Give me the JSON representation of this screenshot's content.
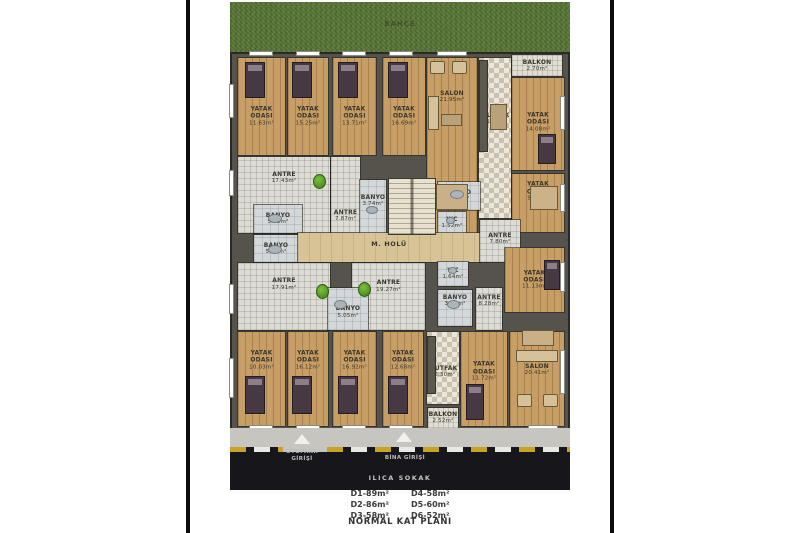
{
  "title": "NORMAL KAT PLANI",
  "street_label": "ILICA SOKAK",
  "garden_label": "BAHÇE",
  "entrances": {
    "otopark_line1": "OTOPARK",
    "otopark_line2": "GİRİŞİ",
    "bina": "BİNA GİRİŞİ"
  },
  "legend": {
    "left": [
      "D1-89m²",
      "D2-86m²",
      "D3-58m²"
    ],
    "right": [
      "D4-58m²",
      "D5-60m²",
      "D6-52m²"
    ]
  },
  "colors": {
    "grass": "#5d7a3a",
    "road": "#17171b",
    "wood_floor": "#c79e66",
    "wall": "#55534c",
    "plant_green": "#4e9b1e",
    "curb_yellow": "#c9a227"
  },
  "rooms": [
    {
      "name": "YATAK ODASI",
      "size": "11.63m²",
      "x": 238,
      "y": 58,
      "w": 47,
      "h": 97,
      "floor": "wood",
      "lt": 0.6
    },
    {
      "name": "YATAK ODASI",
      "size": "15.25m²",
      "x": 288,
      "y": 58,
      "w": 40,
      "h": 97,
      "floor": "wood",
      "lt": 0.6
    },
    {
      "name": "YATAK ODASI",
      "size": "13.71m²",
      "x": 333,
      "y": 58,
      "w": 43,
      "h": 97,
      "floor": "wood",
      "lt": 0.6
    },
    {
      "name": "YATAK ODASI",
      "size": "16.69m²",
      "x": 383,
      "y": 58,
      "w": 42,
      "h": 97,
      "floor": "wood",
      "lt": 0.6
    },
    {
      "name": "SALON",
      "size": "21.95m²",
      "x": 427,
      "y": 58,
      "w": 50,
      "h": 175,
      "floor": "wood",
      "lt": 0.22
    },
    {
      "name": "MUTFAK",
      "size": "11.62m²",
      "x": 479,
      "y": 58,
      "w": 32,
      "h": 160,
      "floor": "check",
      "lt": 0.38
    },
    {
      "name": "BALKON",
      "size": "2.70m²",
      "x": 512,
      "y": 55,
      "w": 50,
      "h": 21,
      "floor": "balk"
    },
    {
      "name": "YATAK ODASI",
      "size": "14.08m²",
      "x": 512,
      "y": 78,
      "w": 52,
      "h": 92,
      "floor": "wood",
      "lt": 0.48
    },
    {
      "name": "YATAK ODASI",
      "size": "9.27m²",
      "x": 512,
      "y": 174,
      "w": 52,
      "h": 58,
      "floor": "wood",
      "lt": 0.3
    },
    {
      "name": "ANTRE",
      "size": "17.43m²",
      "x": 238,
      "y": 157,
      "w": 92,
      "h": 76,
      "floor": "grid",
      "lt": 0.28
    },
    {
      "name": "BANYO",
      "size": "5.35m²",
      "x": 254,
      "y": 205,
      "w": 48,
      "h": 28,
      "floor": "tile"
    },
    {
      "name": "BANYO",
      "size": "5.73m²",
      "x": 254,
      "y": 235,
      "w": 44,
      "h": 27,
      "floor": "tile"
    },
    {
      "name": "ANTRE",
      "size": "7.87m²",
      "x": 331,
      "y": 157,
      "w": 29,
      "h": 76,
      "floor": "grid",
      "lt": 0.78
    },
    {
      "name": "BANYO",
      "size": "3.74m²",
      "x": 360,
      "y": 180,
      "w": 26,
      "h": 55,
      "floor": "tile",
      "lt": 0.38
    },
    {
      "name": "BANYO",
      "size": "4.53m²",
      "x": 438,
      "y": 182,
      "w": 42,
      "h": 28,
      "floor": "tile"
    },
    {
      "name": "WC",
      "size": "1.52m²",
      "x": 438,
      "y": 212,
      "w": 28,
      "h": 22,
      "floor": "tile"
    },
    {
      "name": "M. HOLÜ",
      "size": "",
      "x": 298,
      "y": 233,
      "w": 182,
      "h": 29,
      "floor": "stone",
      "lt": 0.42
    },
    {
      "name": "ANTRE",
      "size": "7.80m²",
      "x": 480,
      "y": 220,
      "w": 40,
      "h": 42,
      "floor": "grid",
      "lt": 0.45
    },
    {
      "name": "ANTRE",
      "size": "17.91m²",
      "x": 238,
      "y": 263,
      "w": 92,
      "h": 67,
      "floor": "grid",
      "lt": 0.32
    },
    {
      "name": "ANTRE",
      "size": "19.27m²",
      "x": 352,
      "y": 263,
      "w": 73,
      "h": 67,
      "floor": "grid",
      "lt": 0.35
    },
    {
      "name": "BANYO",
      "size": "5.05m²",
      "x": 328,
      "y": 288,
      "w": 40,
      "h": 42,
      "floor": "tile",
      "lt": 0.58
    },
    {
      "name": "WC",
      "size": "1.64m²",
      "x": 438,
      "y": 262,
      "w": 30,
      "h": 24,
      "floor": "tile"
    },
    {
      "name": "BANYO",
      "size": "3.83m²",
      "x": 438,
      "y": 290,
      "w": 34,
      "h": 36,
      "floor": "tile",
      "lt": 0.3
    },
    {
      "name": "ANTRE",
      "size": "8.28m²",
      "x": 476,
      "y": 288,
      "w": 26,
      "h": 42,
      "floor": "grid",
      "lt": 0.3
    },
    {
      "name": "YATAK ODASI",
      "size": "11.13m²",
      "x": 505,
      "y": 248,
      "w": 59,
      "h": 64,
      "floor": "wood"
    },
    {
      "name": "YATAK ODASI",
      "size": "10.03m²",
      "x": 238,
      "y": 332,
      "w": 47,
      "h": 94,
      "floor": "wood",
      "lt": 0.3
    },
    {
      "name": "YATAK ODASI",
      "size": "16.12m²",
      "x": 288,
      "y": 332,
      "w": 40,
      "h": 94,
      "floor": "wood",
      "lt": 0.3
    },
    {
      "name": "YATAK ODASI",
      "size": "16.92m²",
      "x": 333,
      "y": 332,
      "w": 43,
      "h": 94,
      "floor": "wood",
      "lt": 0.3
    },
    {
      "name": "YATAK ODASI",
      "size": "12.68m²",
      "x": 383,
      "y": 332,
      "w": 40,
      "h": 94,
      "floor": "wood",
      "lt": 0.3
    },
    {
      "name": "MUTFAK",
      "size": "12.30m²",
      "x": 427,
      "y": 332,
      "w": 32,
      "h": 72,
      "floor": "check",
      "lt": 0.55
    },
    {
      "name": "BALKON",
      "size": "2.52m²",
      "x": 428,
      "y": 408,
      "w": 30,
      "h": 20,
      "floor": "balk"
    },
    {
      "name": "YATAK ODASI",
      "size": "11.72m²",
      "x": 461,
      "y": 332,
      "w": 46,
      "h": 94,
      "floor": "wood",
      "lt": 0.42
    },
    {
      "name": "SALON",
      "size": "20.41m²",
      "x": 510,
      "y": 332,
      "w": 54,
      "h": 94,
      "floor": "wood",
      "lt": 0.4
    }
  ],
  "furniture": [
    {
      "type": "stairs",
      "x": 388,
      "y": 178,
      "w": 48,
      "h": 57
    },
    {
      "type": "counter",
      "x": 479,
      "y": 60,
      "w": 9,
      "h": 92
    },
    {
      "type": "counter",
      "x": 427,
      "y": 336,
      "w": 9,
      "h": 58
    },
    {
      "type": "bed",
      "x": 245,
      "y": 62,
      "w": 20,
      "h": 36
    },
    {
      "type": "bed",
      "x": 292,
      "y": 62,
      "w": 20,
      "h": 36
    },
    {
      "type": "bed",
      "x": 338,
      "y": 62,
      "w": 20,
      "h": 36
    },
    {
      "type": "bed",
      "x": 388,
      "y": 62,
      "w": 20,
      "h": 36
    },
    {
      "type": "bed",
      "x": 245,
      "y": 376,
      "w": 20,
      "h": 38
    },
    {
      "type": "bed",
      "x": 292,
      "y": 376,
      "w": 20,
      "h": 38
    },
    {
      "type": "bed",
      "x": 338,
      "y": 376,
      "w": 20,
      "h": 38
    },
    {
      "type": "bed",
      "x": 388,
      "y": 376,
      "w": 20,
      "h": 38
    },
    {
      "type": "bed",
      "x": 466,
      "y": 384,
      "w": 18,
      "h": 36
    },
    {
      "type": "bed",
      "x": 538,
      "y": 134,
      "w": 18,
      "h": 30
    },
    {
      "type": "bed",
      "x": 544,
      "y": 260,
      "w": 16,
      "h": 30
    },
    {
      "type": "bedlight",
      "x": 530,
      "y": 186,
      "w": 28,
      "h": 24
    },
    {
      "type": "chair",
      "x": 430,
      "y": 61,
      "w": 15,
      "h": 13
    },
    {
      "type": "chair",
      "x": 452,
      "y": 61,
      "w": 15,
      "h": 13
    },
    {
      "type": "chair",
      "x": 517,
      "y": 394,
      "w": 15,
      "h": 13
    },
    {
      "type": "chair",
      "x": 543,
      "y": 394,
      "w": 15,
      "h": 13
    },
    {
      "type": "sofa",
      "x": 428,
      "y": 96,
      "w": 11,
      "h": 34
    },
    {
      "type": "sofa",
      "x": 516,
      "y": 350,
      "w": 42,
      "h": 12
    },
    {
      "type": "table",
      "x": 441,
      "y": 114,
      "w": 21,
      "h": 12
    },
    {
      "type": "table",
      "x": 490,
      "y": 104,
      "w": 17,
      "h": 26
    },
    {
      "type": "dining",
      "x": 436,
      "y": 184,
      "w": 32,
      "h": 26
    },
    {
      "type": "dining",
      "x": 522,
      "y": 330,
      "w": 32,
      "h": 16
    },
    {
      "type": "fixture",
      "x": 268,
      "y": 214,
      "w": 14,
      "h": 9
    },
    {
      "type": "fixture",
      "x": 268,
      "y": 245,
      "w": 14,
      "h": 9
    },
    {
      "type": "fixture",
      "x": 366,
      "y": 206,
      "w": 12,
      "h": 8
    },
    {
      "type": "fixture",
      "x": 450,
      "y": 190,
      "w": 14,
      "h": 9
    },
    {
      "type": "fixture",
      "x": 446,
      "y": 217,
      "w": 9,
      "h": 7
    },
    {
      "type": "fixture",
      "x": 448,
      "y": 267,
      "w": 9,
      "h": 7
    },
    {
      "type": "fixture",
      "x": 447,
      "y": 300,
      "w": 13,
      "h": 9
    },
    {
      "type": "fixture",
      "x": 334,
      "y": 300,
      "w": 13,
      "h": 9
    },
    {
      "type": "plant",
      "x": 313,
      "y": 174,
      "w": 13,
      "h": 15
    },
    {
      "type": "plant",
      "x": 316,
      "y": 284,
      "w": 13,
      "h": 15
    },
    {
      "type": "plant",
      "x": 358,
      "y": 282,
      "w": 13,
      "h": 15
    }
  ],
  "windows": [
    {
      "x": 249,
      "y": 51,
      "w": 24,
      "h": 5
    },
    {
      "x": 296,
      "y": 51,
      "w": 24,
      "h": 5
    },
    {
      "x": 342,
      "y": 51,
      "w": 24,
      "h": 5
    },
    {
      "x": 389,
      "y": 51,
      "w": 24,
      "h": 5
    },
    {
      "x": 437,
      "y": 51,
      "w": 30,
      "h": 5
    },
    {
      "x": 560,
      "y": 96,
      "w": 5,
      "h": 34
    },
    {
      "x": 560,
      "y": 184,
      "w": 5,
      "h": 28
    },
    {
      "x": 560,
      "y": 262,
      "w": 5,
      "h": 30
    },
    {
      "x": 560,
      "y": 350,
      "w": 5,
      "h": 44
    },
    {
      "x": 229,
      "y": 84,
      "w": 5,
      "h": 34
    },
    {
      "x": 229,
      "y": 170,
      "w": 5,
      "h": 26
    },
    {
      "x": 229,
      "y": 284,
      "w": 5,
      "h": 30
    },
    {
      "x": 229,
      "y": 358,
      "w": 5,
      "h": 40
    },
    {
      "x": 249,
      "y": 425,
      "w": 24,
      "h": 5
    },
    {
      "x": 296,
      "y": 425,
      "w": 24,
      "h": 5
    },
    {
      "x": 342,
      "y": 425,
      "w": 24,
      "h": 5
    },
    {
      "x": 389,
      "y": 425,
      "w": 24,
      "h": 5
    },
    {
      "x": 528,
      "y": 425,
      "w": 30,
      "h": 5
    }
  ]
}
